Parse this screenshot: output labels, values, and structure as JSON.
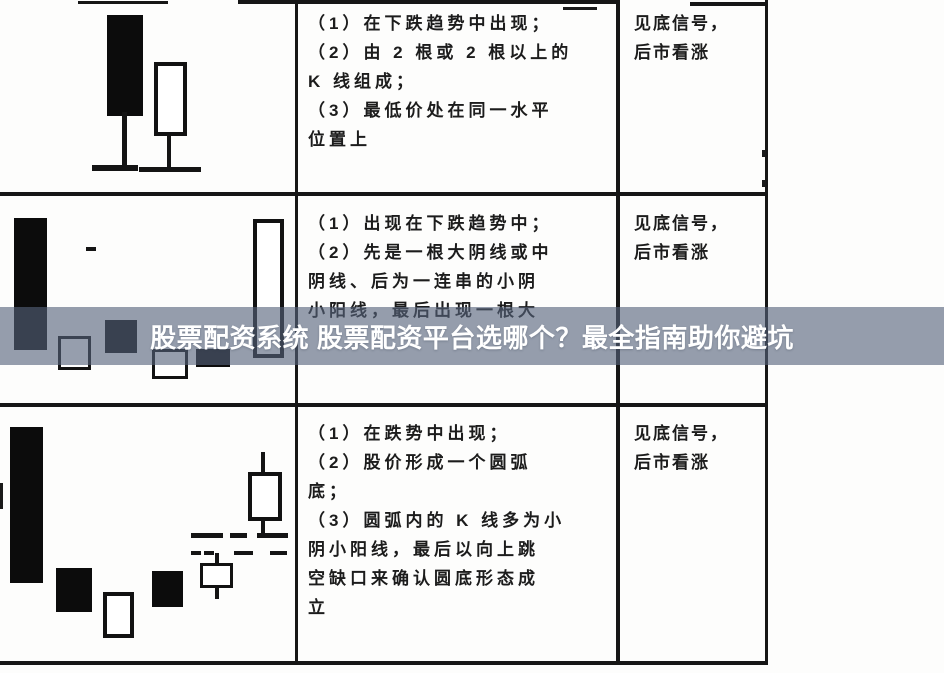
{
  "banner": {
    "text": "股票配资系统 股票配资平台选哪个？最全指南助你避坑",
    "bg_color": "#55627B",
    "bg_opacity": 0.62,
    "text_color": "#FFFFFF"
  },
  "table": {
    "rows": [
      {
        "description_lines": [
          "（1）在下跌趋势中出现；",
          "（2）由 2 根或 2 根以上的",
          "K 线组成；",
          "（3）最低价处在同一水平",
          "位置上"
        ],
        "signal_lines": [
          "见底信号，",
          "后市看涨"
        ],
        "diagram": {
          "type": "candlestick-sketch",
          "elements": [
            {
              "kind": "filled-candle",
              "x": 107,
              "y": 15,
              "w": 36,
              "h": 101
            },
            {
              "kind": "wick",
              "x": 122,
              "y": 112,
              "w": 5,
              "h": 56
            },
            {
              "kind": "baseline",
              "x": 92,
              "y": 165,
              "w": 46,
              "h": 6
            },
            {
              "kind": "hollow-candle",
              "x": 154,
              "y": 62,
              "w": 33,
              "h": 74,
              "b": 4
            },
            {
              "kind": "wick",
              "x": 167,
              "y": 134,
              "w": 4,
              "h": 36
            },
            {
              "kind": "baseline",
              "x": 139,
              "y": 167,
              "w": 62,
              "h": 5
            }
          ]
        }
      },
      {
        "description_lines": [
          "（1）出现在下跌趋势中；",
          "（2）先是一根大阴线或中",
          "阴线、后为一连串的小阴",
          "小阳线，最后出现一根大"
        ],
        "signal_lines": [
          "见底信号，",
          "后市看涨"
        ],
        "diagram": {
          "type": "candlestick-sketch",
          "elements": [
            {
              "kind": "filled-candle",
              "x": 14,
              "y": 218,
              "w": 33,
              "h": 132
            },
            {
              "kind": "dash",
              "x": 86,
              "y": 247,
              "w": 10,
              "h": 4
            },
            {
              "kind": "hollow-candle",
              "x": 58,
              "y": 336,
              "w": 33,
              "h": 34,
              "b": 3
            },
            {
              "kind": "filled-candle",
              "x": 105,
              "y": 320,
              "w": 32,
              "h": 33
            },
            {
              "kind": "hollow-candle",
              "x": 152,
              "y": 349,
              "w": 36,
              "h": 30,
              "b": 3
            },
            {
              "kind": "filled-candle",
              "x": 196,
              "y": 349,
              "w": 34,
              "h": 18
            },
            {
              "kind": "hollow-candle",
              "x": 253,
              "y": 219,
              "w": 31,
              "h": 139,
              "b": 4
            }
          ]
        }
      },
      {
        "description_lines": [
          "（1）在跌势中出现；",
          "（2）股价形成一个圆弧",
          "底；",
          "（3）圆弧内的 K 线多为小",
          "阴小阳线，最后以向上跳",
          "空缺口来确认圆底形态成",
          "立"
        ],
        "signal_lines": [
          "见底信号，",
          "后市看涨"
        ],
        "diagram": {
          "type": "candlestick-sketch",
          "elements": [
            {
              "kind": "filled-candle",
              "x": 10,
              "y": 427,
              "w": 33,
              "h": 156
            },
            {
              "kind": "filled-candle",
              "x": 56,
              "y": 568,
              "w": 36,
              "h": 44
            },
            {
              "kind": "hollow-candle",
              "x": 103,
              "y": 592,
              "w": 31,
              "h": 46,
              "b": 4
            },
            {
              "kind": "filled-candle",
              "x": 152,
              "y": 571,
              "w": 31,
              "h": 36
            },
            {
              "kind": "dash",
              "x": 191,
              "y": 533,
              "w": 32,
              "h": 5
            },
            {
              "kind": "dash",
              "x": 230,
              "y": 533,
              "w": 17,
              "h": 5
            },
            {
              "kind": "dash",
              "x": 257,
              "y": 533,
              "w": 31,
              "h": 5
            },
            {
              "kind": "dash",
              "x": 191,
              "y": 551,
              "w": 10,
              "h": 4
            },
            {
              "kind": "dash",
              "x": 204,
              "y": 551,
              "w": 10,
              "h": 4
            },
            {
              "kind": "dash",
              "x": 234,
              "y": 551,
              "w": 19,
              "h": 4
            },
            {
              "kind": "dash",
              "x": 270,
              "y": 551,
              "w": 17,
              "h": 4
            },
            {
              "kind": "wick",
              "x": 215,
              "y": 553,
              "w": 4,
              "h": 12
            },
            {
              "kind": "hollow-candle",
              "x": 200,
              "y": 563,
              "w": 33,
              "h": 25,
              "b": 3
            },
            {
              "kind": "wick",
              "x": 215,
              "y": 587,
              "w": 4,
              "h": 12
            },
            {
              "kind": "wick",
              "x": 261,
              "y": 452,
              "w": 4,
              "h": 22
            },
            {
              "kind": "hollow-candle",
              "x": 248,
              "y": 472,
              "w": 34,
              "h": 49,
              "b": 4
            },
            {
              "kind": "wick",
              "x": 261,
              "y": 519,
              "w": 4,
              "h": 16
            }
          ]
        }
      }
    ]
  }
}
